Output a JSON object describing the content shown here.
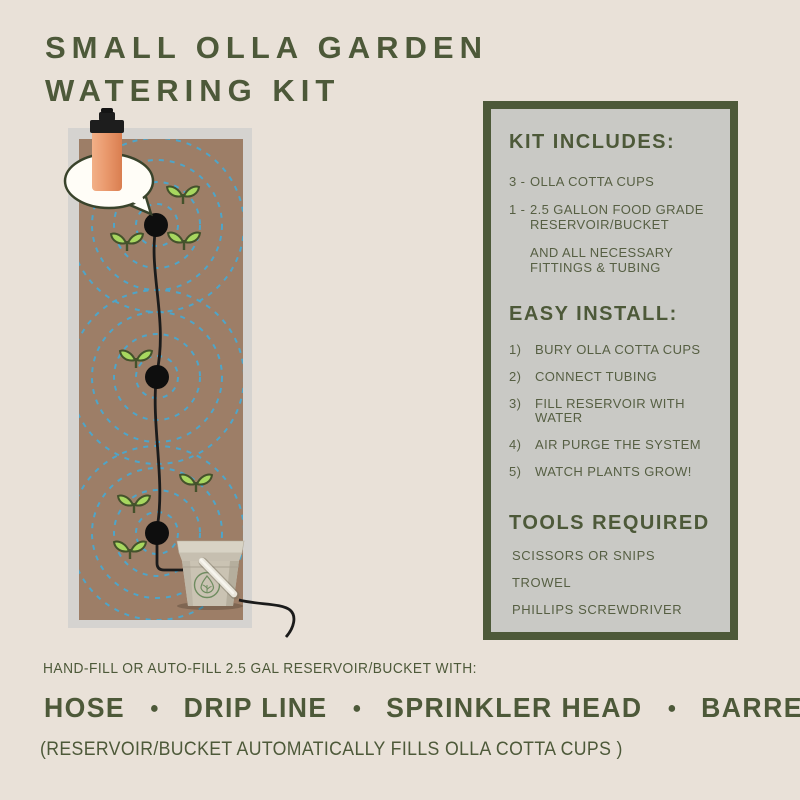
{
  "colors": {
    "background": "#e9e1d8",
    "accent_green": "#4d5939",
    "panel_fill": "#c9c9c5",
    "soil_brown": "#9d7e67",
    "bed_frame_gray": "#d5d3d0",
    "water_ring_blue": "#4ea5c9",
    "sprout_green": "#a7d75f",
    "terracotta": "#e9986c",
    "tube_black": "#1b1b1b"
  },
  "title": {
    "text": "SMALL OLLA GARDEN\nWATERING KIT"
  },
  "panel": {
    "kit": {
      "heading": "KIT INCLUDES:",
      "items": [
        {
          "prefix": "3 -",
          "text": "OLLA COTTA CUPS"
        },
        {
          "prefix": "1 -",
          "text": "2.5 GALLON FOOD GRADE\nRESERVOIR/BUCKET"
        },
        {
          "prefix": "",
          "text": "AND ALL NECESSARY\nFITTINGS & TUBING"
        }
      ]
    },
    "install": {
      "heading": "EASY INSTALL:",
      "items": [
        {
          "num": "1)",
          "text": "BURY OLLA COTTA CUPS"
        },
        {
          "num": "2)",
          "text": "CONNECT TUBING"
        },
        {
          "num": "3)",
          "text": "FILL RESERVOIR WITH WATER"
        },
        {
          "num": "4)",
          "text": "AIR PURGE THE SYSTEM"
        },
        {
          "num": "5)",
          "text": "WATCH PLANTS GROW!"
        }
      ]
    },
    "tools": {
      "heading": "TOOLS REQUIRED",
      "items": [
        "SCISSORS OR SNIPS",
        "TROWEL",
        "PHILLIPS SCREWDRIVER"
      ]
    }
  },
  "footer": {
    "intro": "HAND-FILL OR AUTO-FILL 2.5 GAL RESERVOIR/BUCKET WITH:",
    "methods": [
      "HOSE",
      "DRIP LINE",
      "SPRINKLER HEAD",
      "BARREL"
    ],
    "bullet": "●",
    "note": "(RESERVOIR/BUCKET AUTOMATICALLY FILLS OLLA COTTA CUPS )"
  },
  "illustration": {
    "icons": [
      "raised-garden-bed",
      "soil",
      "watering-radius-rings",
      "buried-olla-dot",
      "sprout-icon",
      "tubing-line",
      "speech-bubble",
      "olla-cotta-cup-icon",
      "reservoir-bucket-icon",
      "bucket-handle",
      "bucket-drop-logo"
    ],
    "olla_cup_count": 3,
    "sprout_count": 7
  }
}
